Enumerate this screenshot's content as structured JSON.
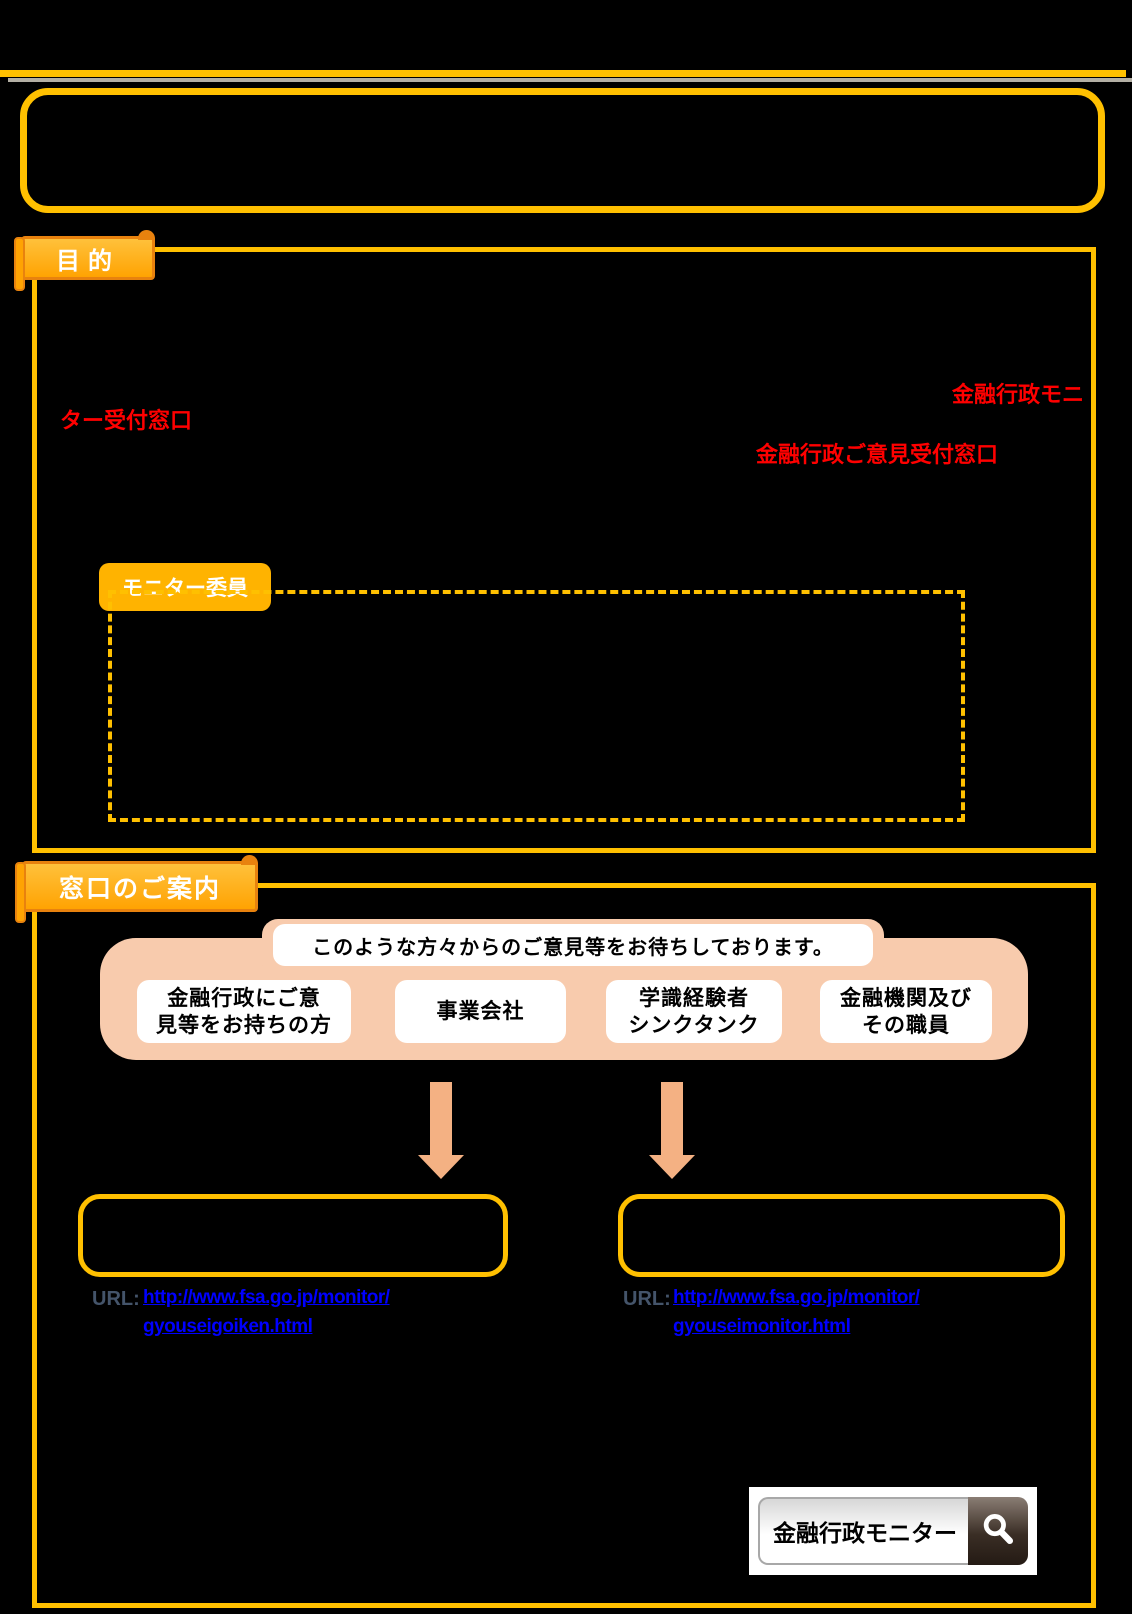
{
  "colors": {
    "accent": "#FFC000",
    "ribbon_border": "#E8820E",
    "peach": "#F8CBAD",
    "arrow": "#F4B183",
    "red_text": "#FF0000",
    "link": "#0000FF",
    "url_label": "#44546A"
  },
  "purpose": {
    "label": "目的",
    "red_fragment_1": "金融行政モニ",
    "red_fragment_2": "ター受付窓口",
    "red_fragment_3": "金融行政ご意見受付窓口",
    "monitor_committee_label": "モニター委員"
  },
  "guide": {
    "label": "窓口のご案内",
    "banner": "このような方々からのご意見等をお待ちしております。",
    "audiences": [
      {
        "line1": "金融行政にご意",
        "line2": "見等をお持ちの方"
      },
      {
        "line1": "事業会社",
        "line2": ""
      },
      {
        "line1": "学識経験者",
        "line2": "シンクタンク"
      },
      {
        "line1": "金融機関及び",
        "line2": "その職員"
      }
    ],
    "windows": [
      {
        "url_label": "URL:",
        "url_line1": "http://www.fsa.go.jp/monitor/",
        "url_line2": "gyouseigoiken.html"
      },
      {
        "url_label": "URL:",
        "url_line1": "http://www.fsa.go.jp/monitor/",
        "url_line2": "gyouseimonitor.html"
      }
    ],
    "search": {
      "query": "金融行政モニター"
    }
  }
}
